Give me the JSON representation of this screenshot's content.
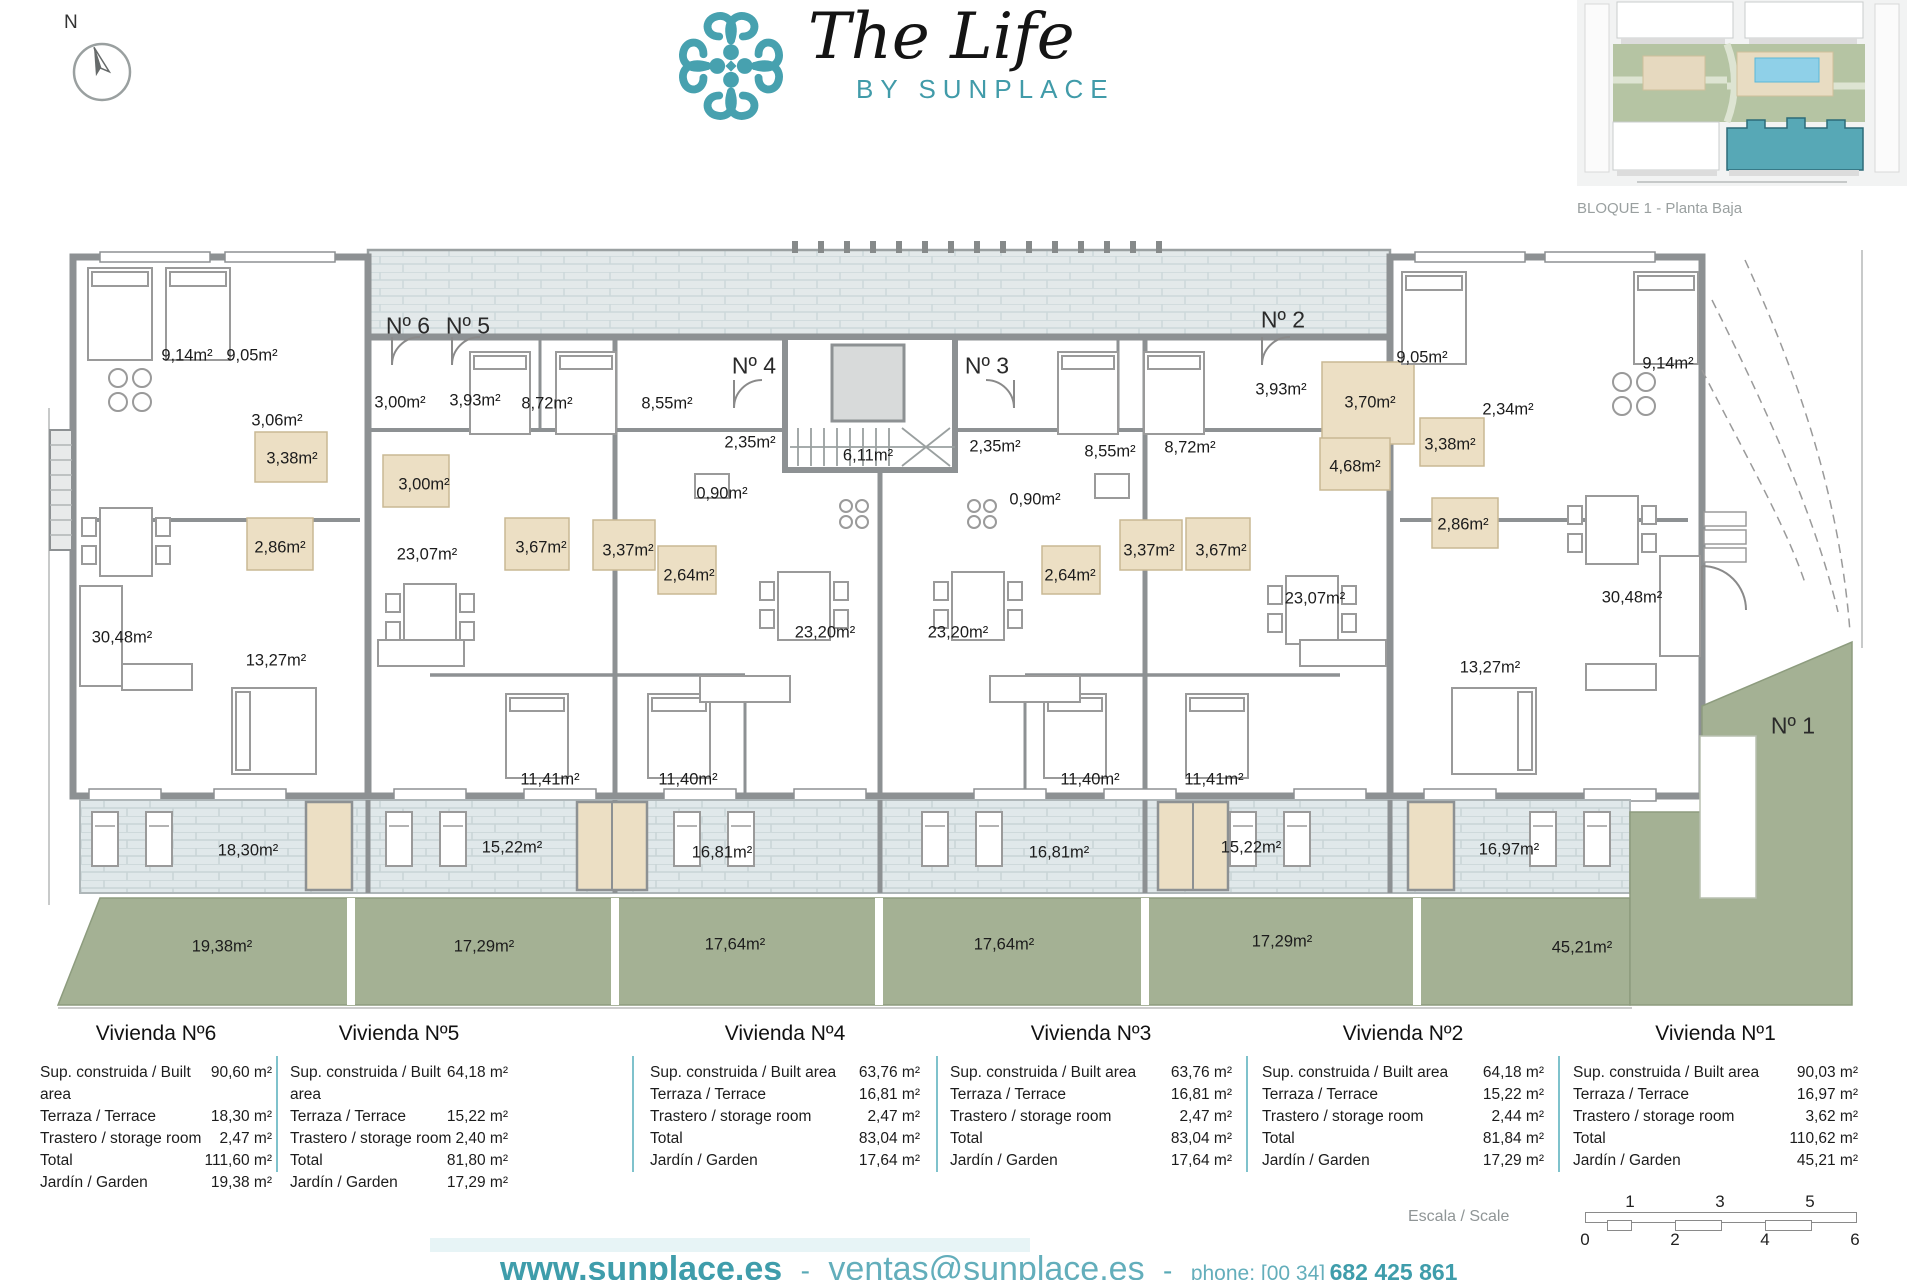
{
  "brand": {
    "title": "The Life",
    "subtitle": "BY SUNPLACE",
    "teal": "#419ba9"
  },
  "compass": {
    "label": "N"
  },
  "inset": {
    "caption": "BLOQUE 1 - Planta Baja"
  },
  "plan": {
    "unit_labels": [
      {
        "t": "Nº 6",
        "x": 408,
        "y": 326
      },
      {
        "t": "Nº 5",
        "x": 468,
        "y": 326
      },
      {
        "t": "Nº 4",
        "x": 754,
        "y": 366
      },
      {
        "t": "Nº 3",
        "x": 987,
        "y": 366
      },
      {
        "t": "Nº 2",
        "x": 1283,
        "y": 320
      },
      {
        "t": "Nº 1",
        "x": 1793,
        "y": 726
      }
    ],
    "room_labels": [
      {
        "t": "9,14m²",
        "x": 187,
        "y": 356
      },
      {
        "t": "9,05m²",
        "x": 252,
        "y": 356
      },
      {
        "t": "3,06m²",
        "x": 277,
        "y": 421
      },
      {
        "t": "3,38m²",
        "x": 292,
        "y": 459
      },
      {
        "t": "2,86m²",
        "x": 280,
        "y": 548
      },
      {
        "t": "30,48m²",
        "x": 122,
        "y": 638
      },
      {
        "t": "13,27m²",
        "x": 276,
        "y": 661
      },
      {
        "t": "3,00m²",
        "x": 400,
        "y": 403
      },
      {
        "t": "3,93m²",
        "x": 475,
        "y": 401
      },
      {
        "t": "3,00m²",
        "x": 424,
        "y": 485
      },
      {
        "t": "8,72m²",
        "x": 547,
        "y": 404
      },
      {
        "t": "8,55m²",
        "x": 667,
        "y": 404
      },
      {
        "t": "23,07m²",
        "x": 427,
        "y": 555
      },
      {
        "t": "3,67m²",
        "x": 541,
        "y": 548
      },
      {
        "t": "3,37m²",
        "x": 628,
        "y": 551
      },
      {
        "t": "11,41m²",
        "x": 550,
        "y": 780
      },
      {
        "t": "11,40m²",
        "x": 688,
        "y": 780
      },
      {
        "t": "2,35m²",
        "x": 750,
        "y": 443
      },
      {
        "t": "0,90m²",
        "x": 722,
        "y": 494
      },
      {
        "t": "2,64m²",
        "x": 689,
        "y": 576
      },
      {
        "t": "23,20m²",
        "x": 825,
        "y": 633
      },
      {
        "t": "6,11m²",
        "x": 868,
        "y": 456
      },
      {
        "t": "23,20m²",
        "x": 958,
        "y": 633
      },
      {
        "t": "2,35m²",
        "x": 995,
        "y": 447
      },
      {
        "t": "0,90m²",
        "x": 1035,
        "y": 500
      },
      {
        "t": "2,64m²",
        "x": 1070,
        "y": 576
      },
      {
        "t": "8,55m²",
        "x": 1110,
        "y": 452
      },
      {
        "t": "8,72m²",
        "x": 1190,
        "y": 448
      },
      {
        "t": "3,37m²",
        "x": 1149,
        "y": 551
      },
      {
        "t": "3,67m²",
        "x": 1221,
        "y": 551
      },
      {
        "t": "11,40m²",
        "x": 1090,
        "y": 780
      },
      {
        "t": "11,41m²",
        "x": 1214,
        "y": 780
      },
      {
        "t": "3,93m²",
        "x": 1281,
        "y": 390
      },
      {
        "t": "3,70m²",
        "x": 1370,
        "y": 403
      },
      {
        "t": "4,68m²",
        "x": 1355,
        "y": 467
      },
      {
        "t": "3,38m²",
        "x": 1450,
        "y": 445
      },
      {
        "t": "2,86m²",
        "x": 1463,
        "y": 525
      },
      {
        "t": "23,07m²",
        "x": 1315,
        "y": 599
      },
      {
        "t": "2,34m²",
        "x": 1508,
        "y": 410
      },
      {
        "t": "9,05m²",
        "x": 1422,
        "y": 358
      },
      {
        "t": "9,14m²",
        "x": 1668,
        "y": 364
      },
      {
        "t": "30,48m²",
        "x": 1632,
        "y": 598
      },
      {
        "t": "13,27m²",
        "x": 1490,
        "y": 668
      }
    ],
    "terrace_labels": [
      {
        "t": "18,30m²",
        "x": 248,
        "y": 851
      },
      {
        "t": "15,22m²",
        "x": 512,
        "y": 848
      },
      {
        "t": "16,81m²",
        "x": 722,
        "y": 853
      },
      {
        "t": "16,81m²",
        "x": 1059,
        "y": 853
      },
      {
        "t": "15,22m²",
        "x": 1251,
        "y": 848
      },
      {
        "t": "16,97m²",
        "x": 1509,
        "y": 850
      }
    ],
    "garden_labels": [
      {
        "t": "19,38m²",
        "x": 222,
        "y": 947
      },
      {
        "t": "17,29m²",
        "x": 484,
        "y": 947
      },
      {
        "t": "17,64m²",
        "x": 735,
        "y": 945
      },
      {
        "t": "17,64m²",
        "x": 1004,
        "y": 945
      },
      {
        "t": "17,29m²",
        "x": 1282,
        "y": 942
      },
      {
        "t": "45,21m²",
        "x": 1582,
        "y": 948
      }
    ]
  },
  "tables": [
    {
      "title": "Vivienda Nº6",
      "rows": [
        {
          "l": "Sup. construida / Built area",
          "v": "90,60 m²"
        },
        {
          "l": "Terraza / Terrace",
          "v": "18,30 m²"
        },
        {
          "l": "Trastero / storage room",
          "v": "2,47 m²"
        },
        {
          "l": "Total",
          "v": "111,60 m²"
        },
        {
          "l": "Jardín / Garden",
          "v": "19,38 m²"
        }
      ]
    },
    {
      "title": "Vivienda Nº5",
      "rows": [
        {
          "l": "Sup. construida / Built area",
          "v": "64,18 m²"
        },
        {
          "l": "Terraza / Terrace",
          "v": "15,22 m²"
        },
        {
          "l": "Trastero / storage room",
          "v": "2,40 m²"
        },
        {
          "l": "Total",
          "v": "81,80 m²"
        },
        {
          "l": "Jardín / Garden",
          "v": "17,29 m²"
        }
      ]
    },
    {
      "title": "Vivienda Nº4",
      "rows": [
        {
          "l": "Sup. construida / Built area",
          "v": "63,76 m²"
        },
        {
          "l": "Terraza / Terrace",
          "v": "16,81 m²"
        },
        {
          "l": "Trastero / storage room",
          "v": "2,47 m²"
        },
        {
          "l": "Total",
          "v": "83,04 m²"
        },
        {
          "l": "Jardín / Garden",
          "v": "17,64 m²"
        }
      ]
    },
    {
      "title": "Vivienda Nº3",
      "rows": [
        {
          "l": "Sup. construida / Built area",
          "v": "63,76 m²"
        },
        {
          "l": "Terraza / Terrace",
          "v": "16,81 m²"
        },
        {
          "l": "Trastero / storage room",
          "v": "2,47 m²"
        },
        {
          "l": "Total",
          "v": "83,04 m²"
        },
        {
          "l": "Jardín / Garden",
          "v": "17,64 m²"
        }
      ]
    },
    {
      "title": "Vivienda Nº2",
      "rows": [
        {
          "l": "Sup. construida / Built area",
          "v": "64,18 m²"
        },
        {
          "l": "Terraza / Terrace",
          "v": "15,22 m²"
        },
        {
          "l": "Trastero / storage room",
          "v": "2,44 m²"
        },
        {
          "l": "Total",
          "v": "81,84 m²"
        },
        {
          "l": "Jardín / Garden",
          "v": "17,29 m²"
        }
      ]
    },
    {
      "title": "Vivienda Nº1",
      "rows": [
        {
          "l": "Sup. construida / Built area",
          "v": "90,03 m²"
        },
        {
          "l": "Terraza / Terrace",
          "v": "16,97 m²"
        },
        {
          "l": "Trastero / storage room",
          "v": "3,62 m²"
        },
        {
          "l": "Total",
          "v": "110,62 m²"
        },
        {
          "l": "Jardín / Garden",
          "v": "45,21 m²"
        }
      ]
    }
  ],
  "scale": {
    "label": "Escala / Scale",
    "top": [
      "1",
      "3",
      "5"
    ],
    "bottom": [
      "0",
      "2",
      "4",
      "6"
    ]
  },
  "footer": {
    "website": "www.sunplace.es",
    "sep": "-",
    "email": "ventas@sunplace.es",
    "phone_label": "phone: [00 34]",
    "phone": "682 425 861"
  }
}
